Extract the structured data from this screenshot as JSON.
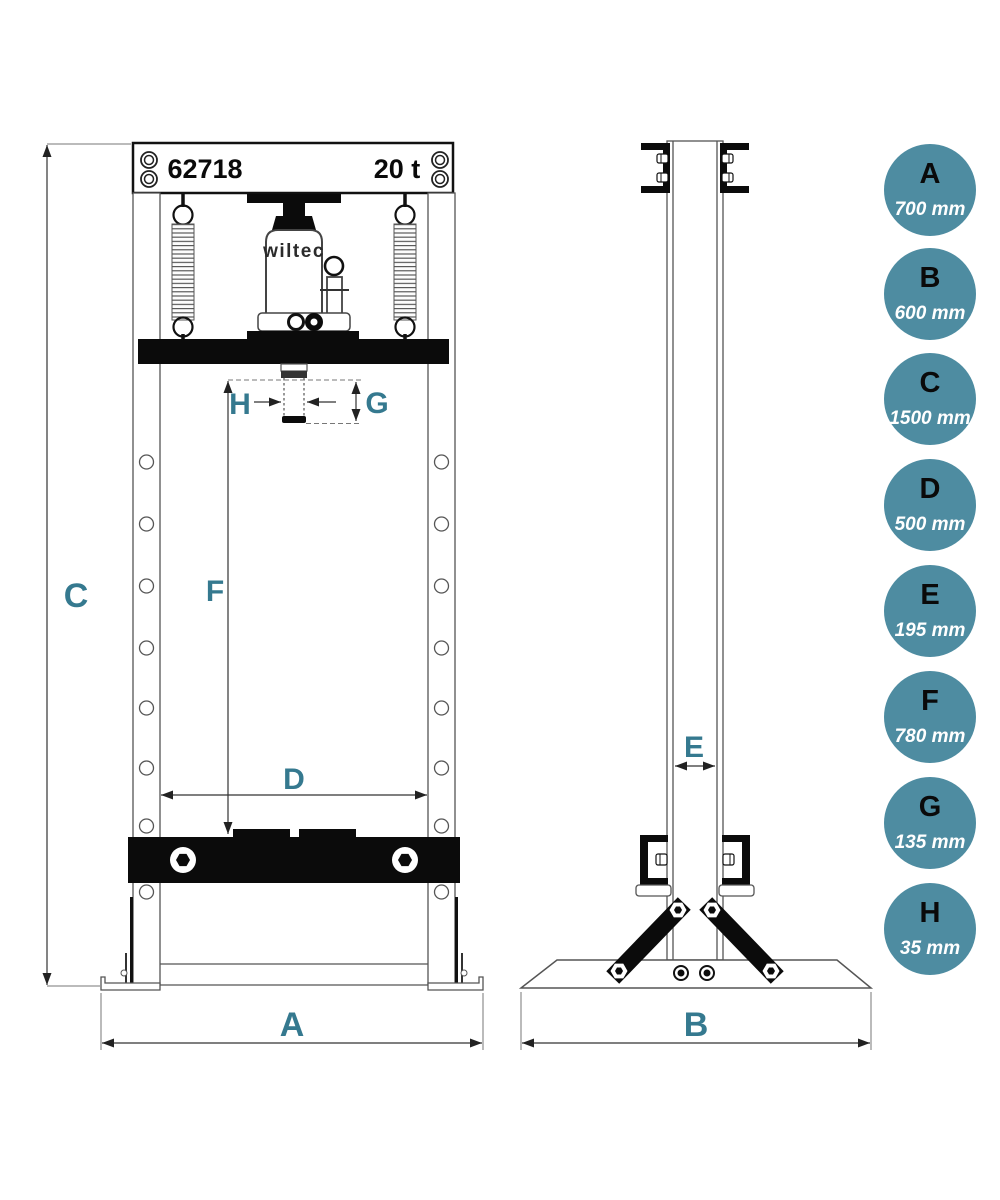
{
  "drawing": {
    "header": {
      "model": "62718",
      "capacity": "20 t"
    },
    "jack_brand": "wiltec"
  },
  "dimensions": [
    {
      "letter": "A",
      "value": "700 mm"
    },
    {
      "letter": "B",
      "value": "600 mm"
    },
    {
      "letter": "C",
      "value": "1500 mm"
    },
    {
      "letter": "D",
      "value": "500 mm"
    },
    {
      "letter": "E",
      "value": "195 mm"
    },
    {
      "letter": "F",
      "value": "780 mm"
    },
    {
      "letter": "G",
      "value": "135 mm"
    },
    {
      "letter": "H",
      "value": "35 mm"
    }
  ],
  "colors": {
    "accent": "#35798f",
    "legend_circle": "#4e8ca1",
    "ink": "#0b0b0b",
    "line": "#555555"
  }
}
